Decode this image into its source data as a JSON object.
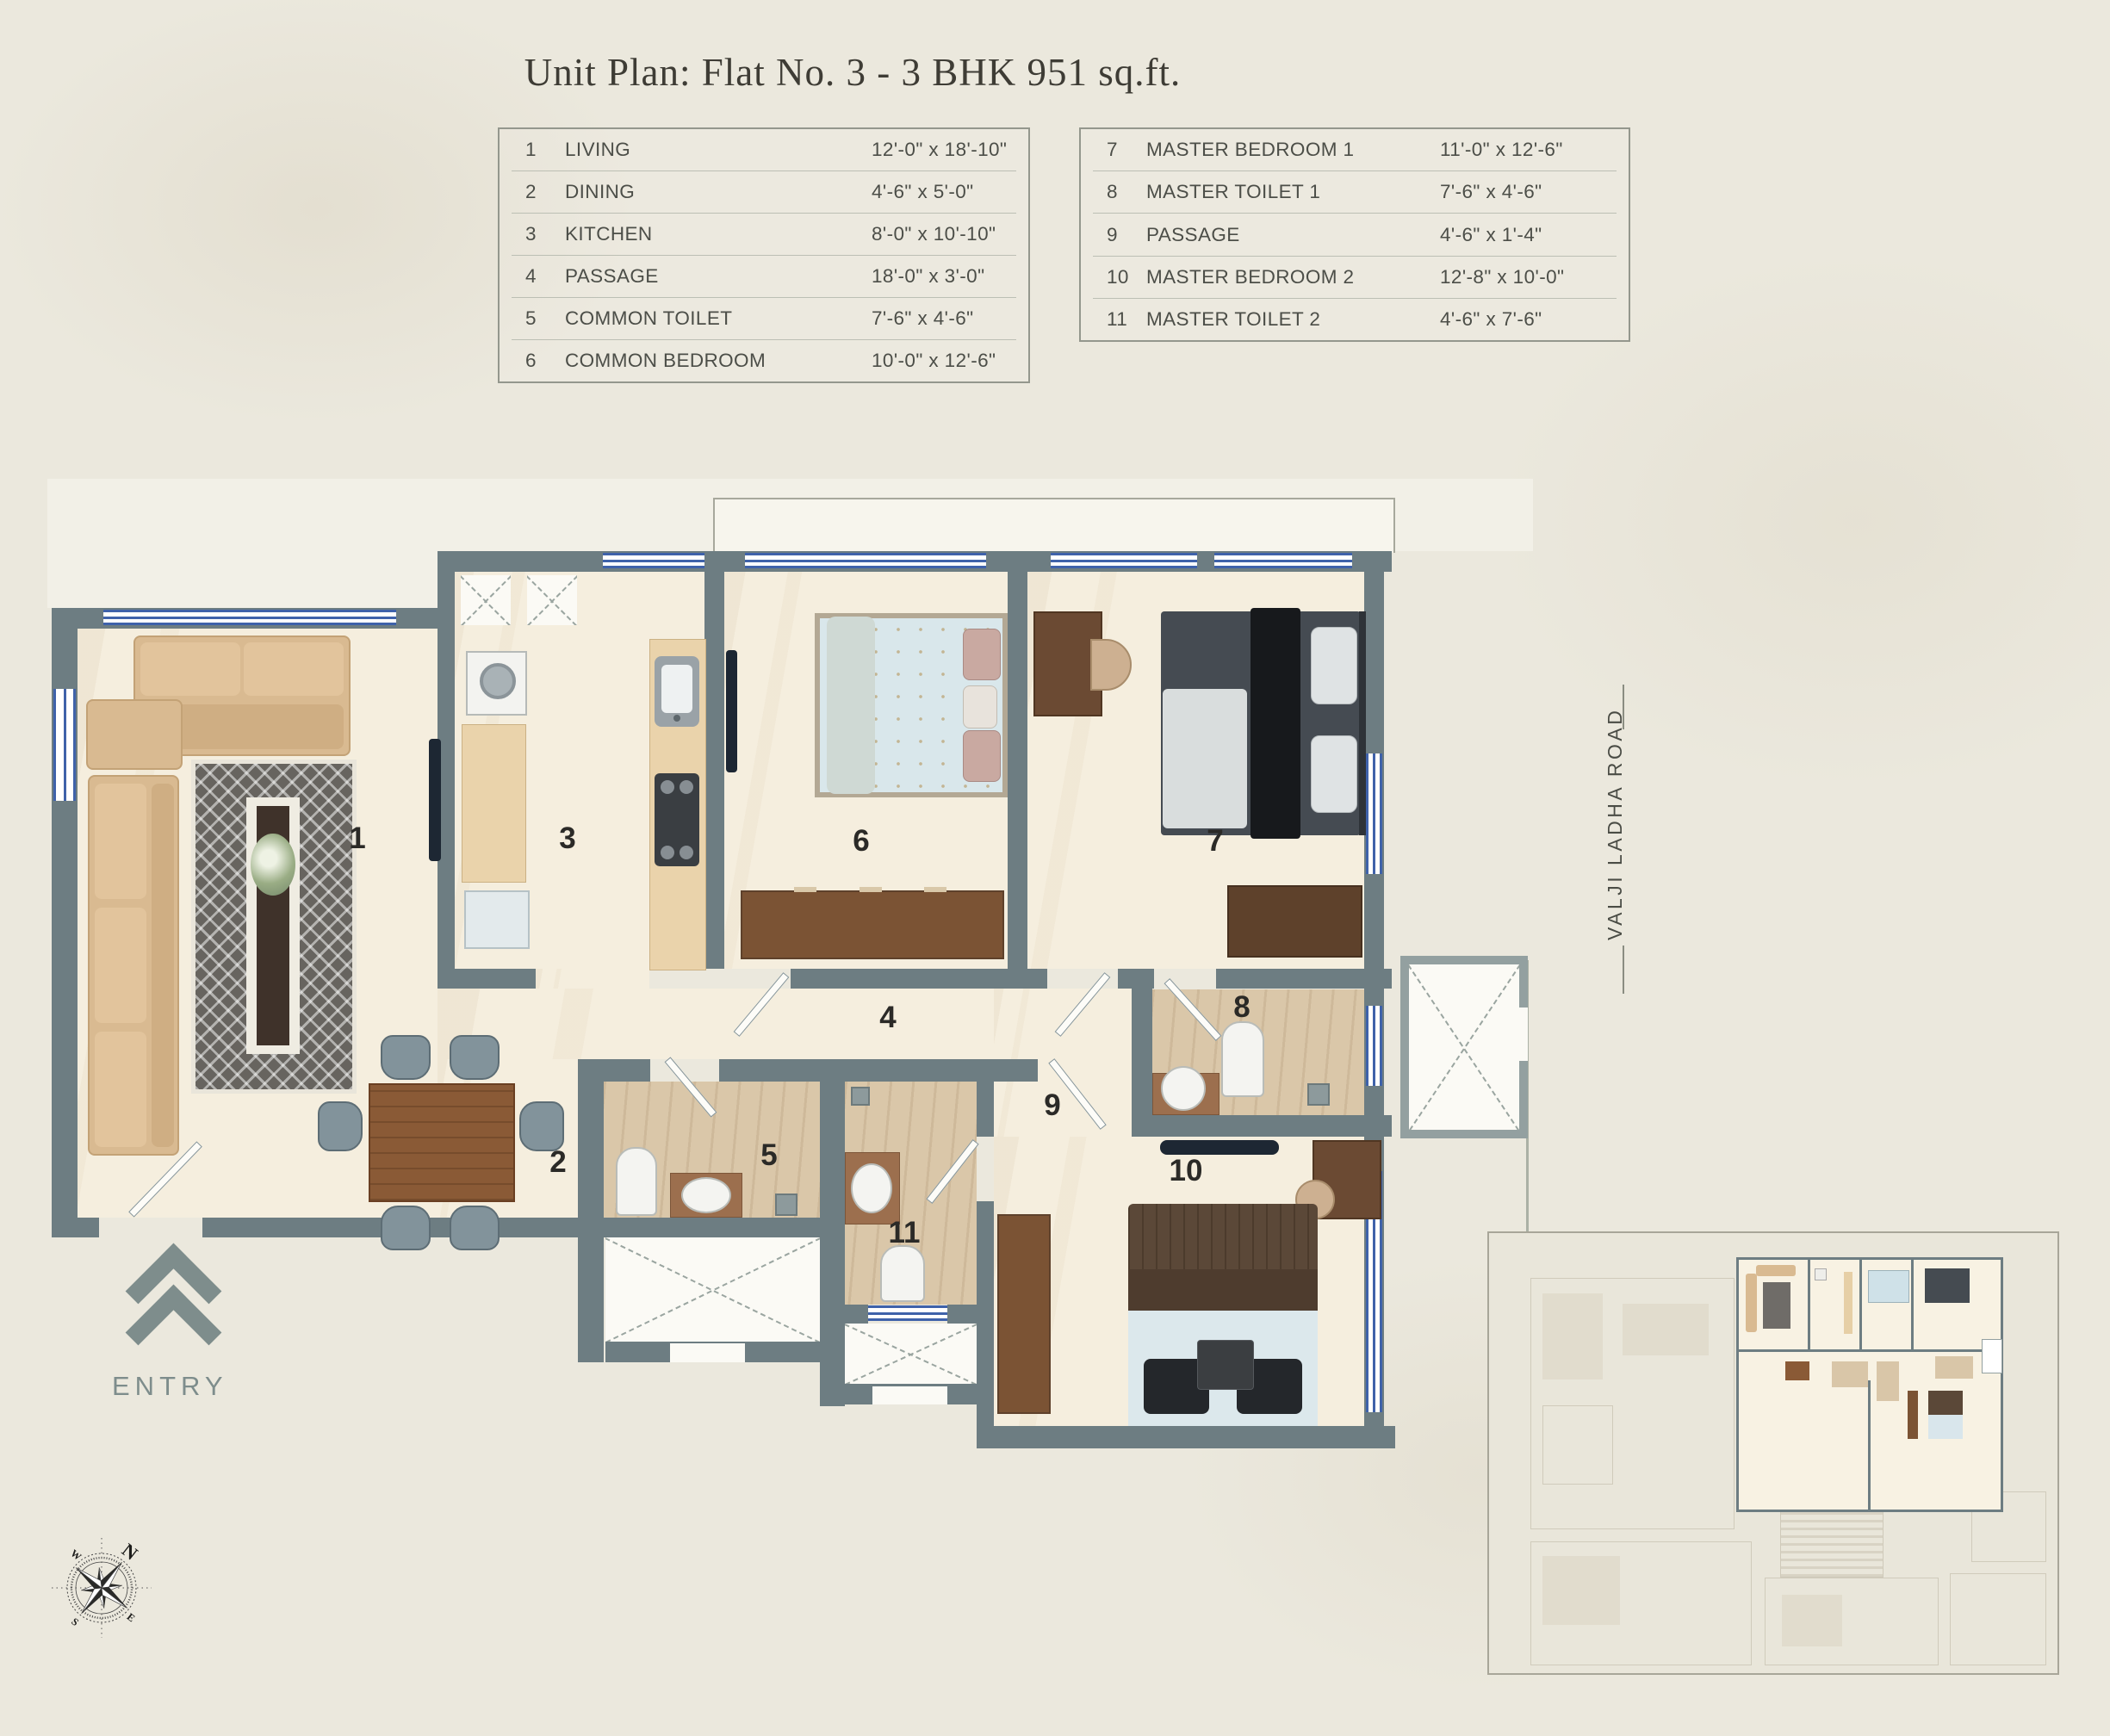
{
  "title": "Unit Plan: Flat No. 3 - 3 BHK 951 sq.ft.",
  "legend": {
    "left": [
      {
        "num": "1",
        "name": "LIVING",
        "dims": "12'-0\" x 18'-10\""
      },
      {
        "num": "2",
        "name": "DINING",
        "dims": "4'-6\" x 5'-0\""
      },
      {
        "num": "3",
        "name": "KITCHEN",
        "dims": "8'-0\" x 10'-10\""
      },
      {
        "num": "4",
        "name": "PASSAGE",
        "dims": "18'-0\" x 3'-0\""
      },
      {
        "num": "5",
        "name": "COMMON TOILET",
        "dims": "7'-6\" x 4'-6\""
      },
      {
        "num": "6",
        "name": "COMMON BEDROOM",
        "dims": "10'-0\" x 12'-6\""
      }
    ],
    "right": [
      {
        "num": "7",
        "name": "MASTER BEDROOM 1",
        "dims": "11'-0\" x 12'-6\""
      },
      {
        "num": "8",
        "name": "MASTER TOILET 1",
        "dims": "7'-6\" x 4'-6\""
      },
      {
        "num": "9",
        "name": "PASSAGE",
        "dims": "4'-6\" x 1'-4\""
      },
      {
        "num": "10",
        "name": "MASTER BEDROOM 2",
        "dims": "12'-8\" x 10'-0\""
      },
      {
        "num": "11",
        "name": "MASTER TOILET 2",
        "dims": "4'-6\" x 7'-6\""
      }
    ]
  },
  "plan": {
    "rooms": [
      {
        "num": "1"
      },
      {
        "num": "2"
      },
      {
        "num": "3"
      },
      {
        "num": "4"
      },
      {
        "num": "5"
      },
      {
        "num": "6"
      },
      {
        "num": "7"
      },
      {
        "num": "8"
      },
      {
        "num": "9"
      },
      {
        "num": "10"
      },
      {
        "num": "11"
      }
    ],
    "entry_label": "ENTRY",
    "road_label": "VALJI LADHA ROAD",
    "compass": {
      "n": "N",
      "e": "E",
      "s": "S",
      "w": "W"
    }
  }
}
